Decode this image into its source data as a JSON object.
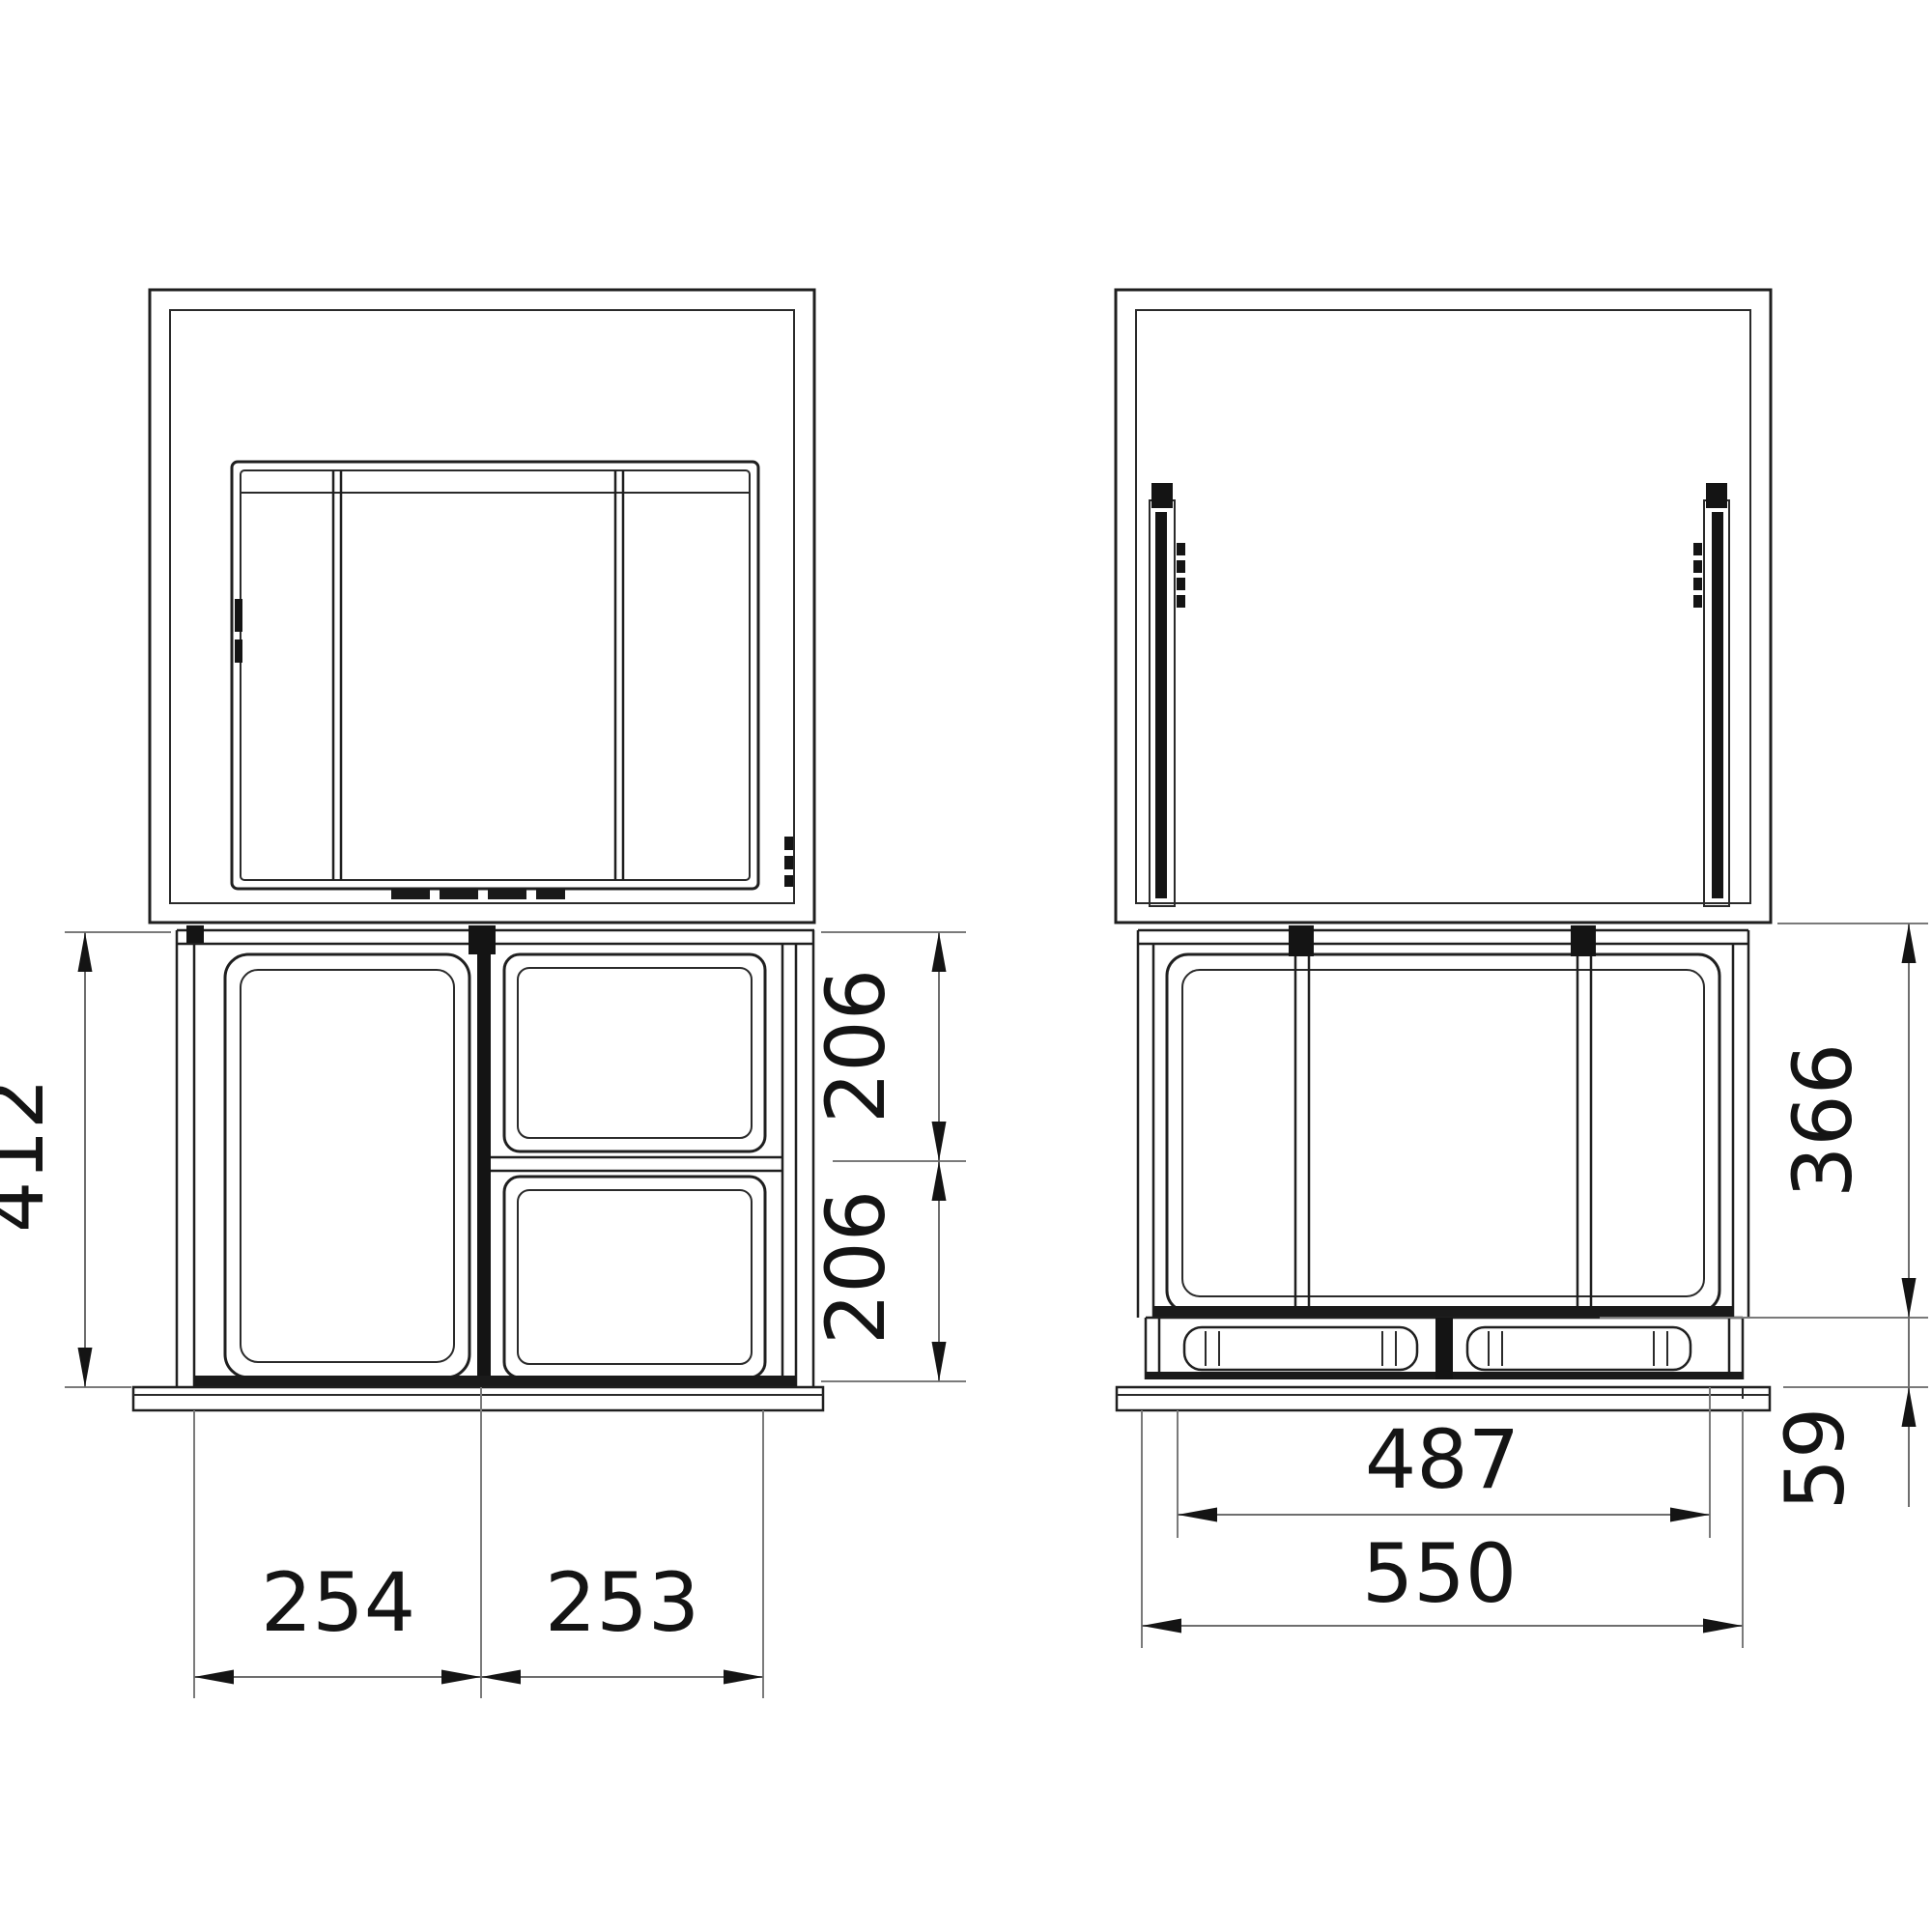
{
  "title": "waste-sorter-cabinet-installation-drawing",
  "colors": {
    "background": "#ffffff",
    "drawing_line": "#1f1f1f",
    "dimension_line": "#6e6e6e",
    "text": "#141414"
  },
  "front_view": {
    "dim_bin_height_total": "412",
    "dim_bin_upper": "206",
    "dim_bin_lower": "206",
    "dim_width_left": "254",
    "dim_width_right": "253"
  },
  "side_view": {
    "dim_bin_height": "366",
    "dim_base_height": "59",
    "dim_depth_inner": "487",
    "dim_depth_total": "550"
  }
}
